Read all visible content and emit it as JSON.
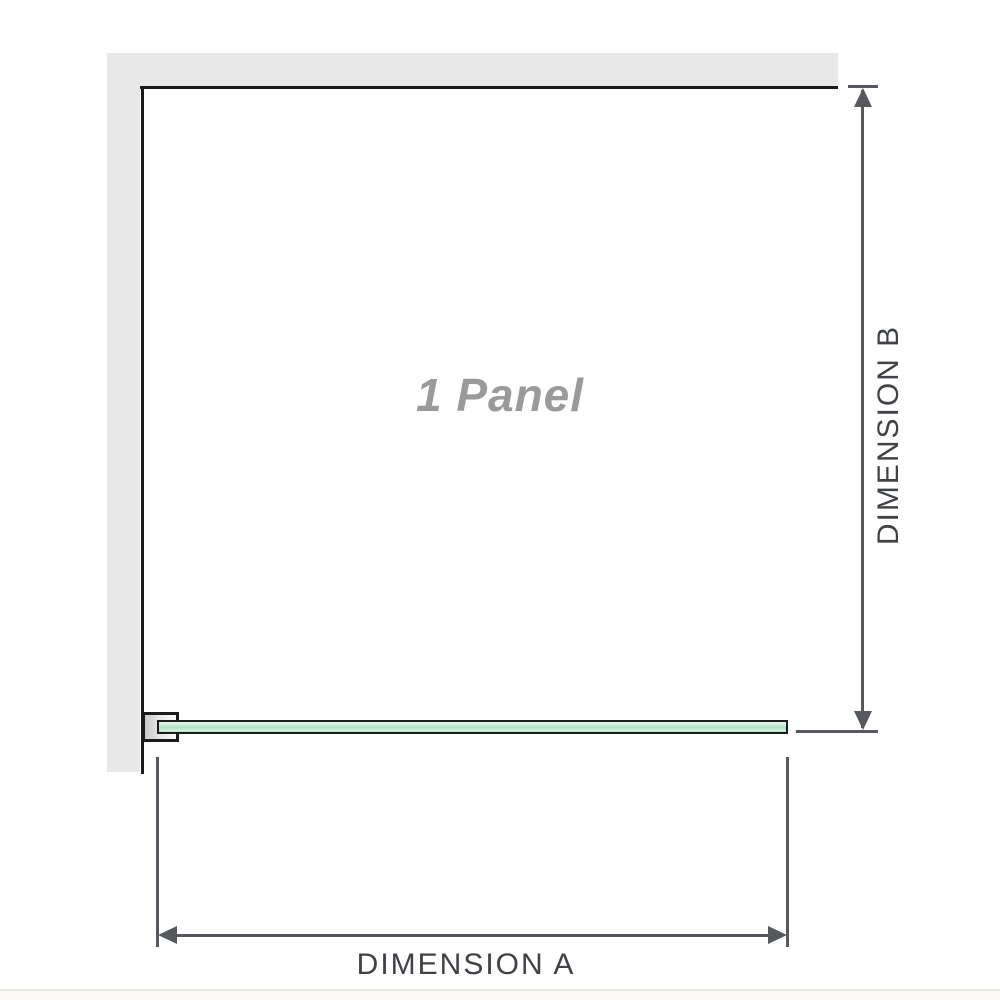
{
  "diagram": {
    "panel_label": "1 Panel",
    "dimension_a": {
      "label": "DIMENSION A",
      "orientation": "horizontal"
    },
    "dimension_b": {
      "label": "DIMENSION B",
      "orientation": "vertical"
    }
  },
  "colors": {
    "wall": "#e8e8e8",
    "outline": "#1b1b1b",
    "dimension_line": "#55585c",
    "label_text": "#3f4246",
    "panel_label_text": "#9a9a9a",
    "glass_green": "#a6dcbb",
    "bracket_fill": "#c9c9c9"
  }
}
